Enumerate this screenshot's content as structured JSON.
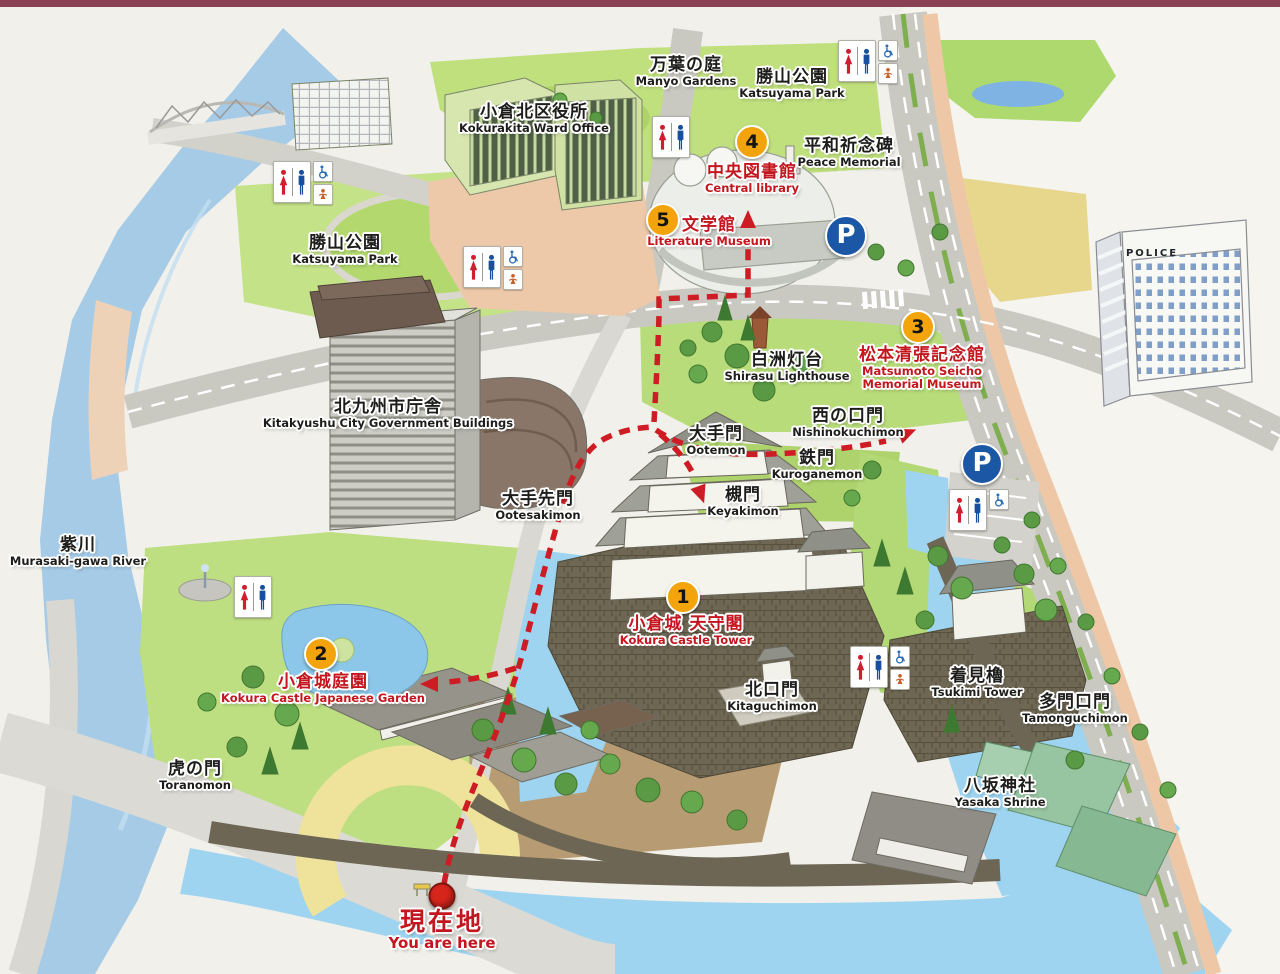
{
  "map_title": "Kokura Castle Area Illustrated Guide Map",
  "parking_label": "P",
  "colors": {
    "route_red": "#ce1c24",
    "label_red": "#c3161e",
    "badge_orange": "#f3a30b",
    "parking_blue": "#1c57a5",
    "river_blue": "#a6cbe7",
    "moat_blue": "#9ed4f0",
    "park_green": "#bede82",
    "frame_maroon": "#8a4154"
  },
  "places": [
    {
      "id": "manyo-gardens",
      "ja": "万葉の庭",
      "en": "Manyo Gardens",
      "x": 686,
      "y": 55,
      "color": "black"
    },
    {
      "id": "katsuyama-park-north",
      "ja": "勝山公園",
      "en": "Katsuyama Park",
      "x": 792,
      "y": 67,
      "color": "black"
    },
    {
      "id": "kokurakita-ward-office",
      "ja": "小倉北区役所",
      "en": "Kokurakita Ward Office",
      "x": 534,
      "y": 102,
      "color": "black"
    },
    {
      "id": "peace-memorial",
      "ja": "平和祈念碑",
      "en": "Peace Memorial",
      "x": 849,
      "y": 136,
      "color": "black"
    },
    {
      "id": "central-library",
      "ja": "中央図書館",
      "en": "Central library",
      "x": 752,
      "y": 162,
      "color": "red"
    },
    {
      "id": "literature-museum",
      "ja": "文学館",
      "en": "Literature Museum",
      "x": 709,
      "y": 215,
      "color": "red"
    },
    {
      "id": "katsuyama-park-west",
      "ja": "勝山公園",
      "en": "Katsuyama Park",
      "x": 345,
      "y": 233,
      "color": "black"
    },
    {
      "id": "police-station",
      "ja": "",
      "en": "POLICE",
      "x": 1152,
      "y": 247,
      "color": "black",
      "size": "tiny"
    },
    {
      "id": "matsumoto-seicho-memorial-museum",
      "ja": "松本清張記念館",
      "en": "Matsumoto Seicho\nMemorial Museum",
      "x": 922,
      "y": 345,
      "color": "red"
    },
    {
      "id": "shirasu-lighthouse",
      "ja": "白洲灯台",
      "en": "Shirasu Lighthouse",
      "x": 787,
      "y": 350,
      "color": "black"
    },
    {
      "id": "kitakyushu-city-government",
      "ja": "北九州市庁舎",
      "en": "Kitakyushu City Government Buildings",
      "x": 388,
      "y": 397,
      "color": "black"
    },
    {
      "id": "nishinokuchimon",
      "ja": "西の口門",
      "en": "Nishinokuchimon",
      "x": 848,
      "y": 406,
      "color": "black"
    },
    {
      "id": "ootemon",
      "ja": "大手門",
      "en": "Ootemon",
      "x": 716,
      "y": 424,
      "color": "black"
    },
    {
      "id": "kuroganemon",
      "ja": "鉄門",
      "en": "Kuroganemon",
      "x": 817,
      "y": 448,
      "color": "black"
    },
    {
      "id": "keyakimon",
      "ja": "槻門",
      "en": "Keyakimon",
      "x": 743,
      "y": 485,
      "color": "black"
    },
    {
      "id": "ootesakimon",
      "ja": "大手先門",
      "en": "Ootesakimon",
      "x": 538,
      "y": 489,
      "color": "black"
    },
    {
      "id": "murasaki-gawa-river",
      "ja": "紫川",
      "en": "Murasaki-gawa River",
      "x": 78,
      "y": 535,
      "color": "black"
    },
    {
      "id": "kokura-castle-tower",
      "ja": "小倉城 天守閣",
      "en": "Kokura Castle Tower",
      "x": 686,
      "y": 614,
      "color": "red"
    },
    {
      "id": "tsukimi-tower",
      "ja": "着見櫓",
      "en": "Tsukimi Tower",
      "x": 977,
      "y": 666,
      "color": "black"
    },
    {
      "id": "kokura-castle-garden",
      "ja": "小倉城庭園",
      "en": "Kokura Castle Japanese Garden",
      "x": 323,
      "y": 672,
      "color": "red"
    },
    {
      "id": "kitaguchimon",
      "ja": "北口門",
      "en": "Kitaguchimon",
      "x": 772,
      "y": 680,
      "color": "black"
    },
    {
      "id": "tamonguchimon",
      "ja": "多門口門",
      "en": "Tamonguchimon",
      "x": 1075,
      "y": 692,
      "color": "black"
    },
    {
      "id": "toranomon",
      "ja": "虎の門",
      "en": "Toranomon",
      "x": 195,
      "y": 759,
      "color": "black"
    },
    {
      "id": "yasaka-shrine",
      "ja": "八坂神社",
      "en": "Yasaka Shrine",
      "x": 1000,
      "y": 776,
      "color": "black"
    },
    {
      "id": "you-are-here",
      "ja": "現在地",
      "en": "You are here",
      "x": 442,
      "y": 908,
      "color": "red",
      "size": "large"
    }
  ],
  "badges": [
    {
      "number": "1",
      "site": "kokura-castle-tower",
      "x": 683,
      "y": 597
    },
    {
      "number": "2",
      "site": "kokura-castle-garden",
      "x": 321,
      "y": 654
    },
    {
      "number": "3",
      "site": "matsumoto-seicho-memorial-museum",
      "x": 918,
      "y": 327
    },
    {
      "number": "4",
      "site": "central-library",
      "x": 752,
      "y": 142
    },
    {
      "number": "5",
      "site": "literature-museum",
      "x": 663,
      "y": 220
    }
  ],
  "parking": [
    {
      "x": 846,
      "y": 236
    },
    {
      "x": 982,
      "y": 464
    }
  ],
  "facilities": {
    "toilets": [
      {
        "x": 838,
        "y": 40,
        "extras": [
          "wheelchair",
          "baby"
        ]
      },
      {
        "x": 652,
        "y": 116,
        "extras": []
      },
      {
        "x": 273,
        "y": 161,
        "extras": [
          "wheelchair",
          "baby"
        ]
      },
      {
        "x": 463,
        "y": 246,
        "extras": [
          "wheelchair",
          "baby"
        ]
      },
      {
        "x": 949,
        "y": 489,
        "extras": [
          "wheelchair"
        ]
      },
      {
        "x": 234,
        "y": 576,
        "extras": []
      },
      {
        "x": 850,
        "y": 646,
        "extras": [
          "wheelchair",
          "baby"
        ]
      }
    ]
  },
  "you_are_here_marker": {
    "x": 442,
    "y": 896
  }
}
